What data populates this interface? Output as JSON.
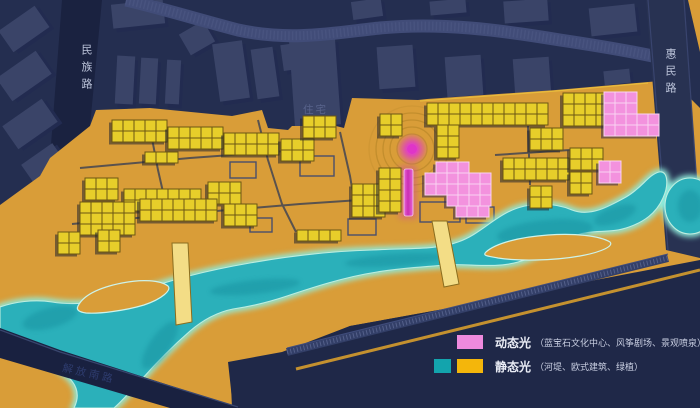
{
  "palette": {
    "background": "#242e50",
    "shore": "#1f2848",
    "roadDark": "#1a2240",
    "building": "#3a4468",
    "buildingShadow": "#222b50",
    "roadTexture": "#414c78",
    "orange": "#d99d38",
    "orangeStreet": "#2f3a56",
    "yellow": "#e7ce2a",
    "yellowStroke": "#6b5613",
    "pink": "#f392de",
    "pinkStroke": "#f9d3f1",
    "teal": "#2bb0ba",
    "tealGlow": "#93eedd",
    "tealDark": "#1b96a4",
    "magenta": "#d22ebc",
    "bridge": "#f3dd86",
    "bridgeStroke": "#8a6d1f",
    "labelLight": "#bcc4da",
    "labelFaint": "#59648c",
    "labelRoadDark": "#2e3c6e",
    "legendTitle": "#e9ecf5",
    "legendDesc": "#c9cfe2",
    "legendTeal": "#13a4ad",
    "legendOrange": "#f4b60b",
    "legendPink": "#ee8ade",
    "ringStroke": "#bf8c2c"
  },
  "labels": {
    "road_left": "民族路",
    "road_right": "惠民路",
    "residential": "住宅",
    "road_bottom": "解放南路"
  },
  "legend": {
    "rows": [
      {
        "label": "动态光",
        "desc": "（蓝宝石文化中心、风筝剧场、景观喷泉）",
        "swatches": [
          "pink"
        ]
      },
      {
        "label": "静态光",
        "desc": "（河堤、欧式建筑、绿植）",
        "swatches": [
          "teal",
          "orange"
        ]
      }
    ]
  },
  "map": {
    "cell": 11,
    "yellow_clusters": [
      [
        112,
        120,
        5,
        2
      ],
      [
        168,
        127,
        5,
        2
      ],
      [
        224,
        133,
        5,
        2
      ],
      [
        281,
        139,
        3,
        2
      ],
      [
        145,
        152,
        3,
        1
      ],
      [
        85,
        178,
        3,
        2
      ],
      [
        124,
        189,
        7,
        2
      ],
      [
        208,
        182,
        3,
        2
      ],
      [
        80,
        202,
        5,
        3
      ],
      [
        140,
        199,
        7,
        2
      ],
      [
        224,
        204,
        3,
        2
      ],
      [
        58,
        232,
        2,
        2
      ],
      [
        98,
        230,
        2,
        2
      ],
      [
        297,
        230,
        4,
        1
      ],
      [
        303,
        116,
        3,
        2
      ],
      [
        380,
        114,
        2,
        2
      ],
      [
        352,
        184,
        3,
        3
      ],
      [
        379,
        168,
        2,
        4
      ],
      [
        427,
        103,
        11,
        2
      ],
      [
        437,
        125,
        2,
        3
      ],
      [
        563,
        93,
        4,
        3
      ],
      [
        530,
        128,
        3,
        2
      ],
      [
        503,
        158,
        6,
        2
      ],
      [
        570,
        148,
        3,
        2
      ],
      [
        570,
        172,
        2,
        2
      ],
      [
        530,
        186,
        2,
        2
      ]
    ],
    "pink_clusters": [
      [
        436,
        162,
        3,
        1
      ],
      [
        425,
        173,
        6,
        1
      ],
      [
        425,
        184,
        6,
        1
      ],
      [
        447,
        195,
        4,
        1
      ],
      [
        456,
        206,
        3,
        1
      ],
      [
        604,
        92,
        3,
        2
      ],
      [
        604,
        114,
        5,
        2
      ],
      [
        599,
        161,
        2,
        2
      ]
    ],
    "navy_buildings": [
      [
        2,
        16,
        44,
        26,
        -35
      ],
      [
        0,
        62,
        48,
        28,
        -35
      ],
      [
        6,
        110,
        48,
        28,
        -35
      ],
      [
        24,
        152,
        38,
        22,
        -35
      ],
      [
        112,
        2,
        52,
        24,
        -6
      ],
      [
        116,
        56,
        18,
        48,
        3
      ],
      [
        140,
        58,
        17,
        46,
        3
      ],
      [
        166,
        60,
        14,
        44,
        3
      ],
      [
        183,
        26,
        28,
        24,
        -30
      ],
      [
        216,
        42,
        30,
        58,
        -8
      ],
      [
        254,
        48,
        22,
        50,
        -8
      ],
      [
        282,
        44,
        16,
        26,
        -8
      ],
      [
        292,
        40,
        46,
        86,
        -4
      ],
      [
        352,
        0,
        30,
        18,
        -8
      ],
      [
        430,
        0,
        36,
        14,
        -5
      ],
      [
        504,
        0,
        44,
        22,
        -4
      ],
      [
        590,
        6,
        46,
        28,
        -6
      ],
      [
        650,
        0,
        28,
        16,
        -6
      ],
      [
        378,
        46,
        36,
        42,
        -4
      ],
      [
        446,
        56,
        36,
        40,
        -4
      ],
      [
        514,
        58,
        36,
        38,
        -4
      ],
      [
        604,
        70,
        26,
        14,
        -6
      ]
    ],
    "outline_buildings": [
      [
        300,
        156,
        34,
        20
      ],
      [
        230,
        162,
        26,
        16
      ],
      [
        420,
        202,
        40,
        20
      ],
      [
        466,
        207,
        28,
        16
      ],
      [
        348,
        219,
        28,
        16
      ],
      [
        250,
        218,
        22,
        14
      ],
      [
        404,
        378,
        30,
        26
      ],
      [
        446,
        366,
        18,
        14
      ],
      [
        482,
        388,
        32,
        18
      ],
      [
        614,
        288,
        22,
        10
      ]
    ]
  }
}
